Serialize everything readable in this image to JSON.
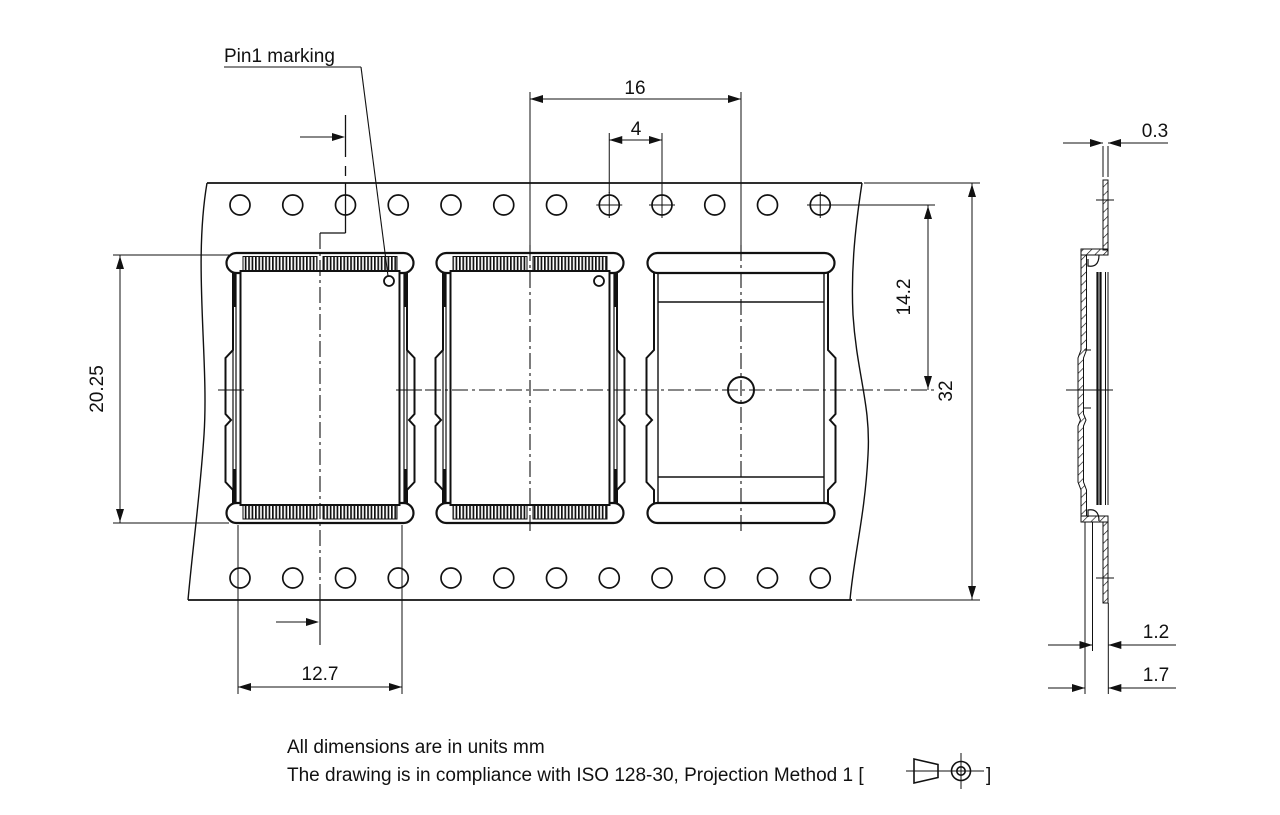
{
  "drawing": {
    "labels": {
      "pin1": "Pin1 marking"
    },
    "dims": {
      "pocket_pitch": "16",
      "hole_pitch": "4",
      "pocket_length": "20.25",
      "pocket_width": "12.7",
      "hole_to_center": "14.2",
      "tape_width": "32",
      "tape_thickness": "0.3",
      "cavity_depth": "1.2",
      "total_depth": "1.7"
    },
    "notes": {
      "units": "All dimensions are in units mm",
      "compliance_prefix": "The drawing is in compliance with ISO 128-30, Projection Method 1 [",
      "compliance_suffix": "]"
    },
    "colors": {
      "line": "#111111",
      "background": "#ffffff"
    }
  }
}
